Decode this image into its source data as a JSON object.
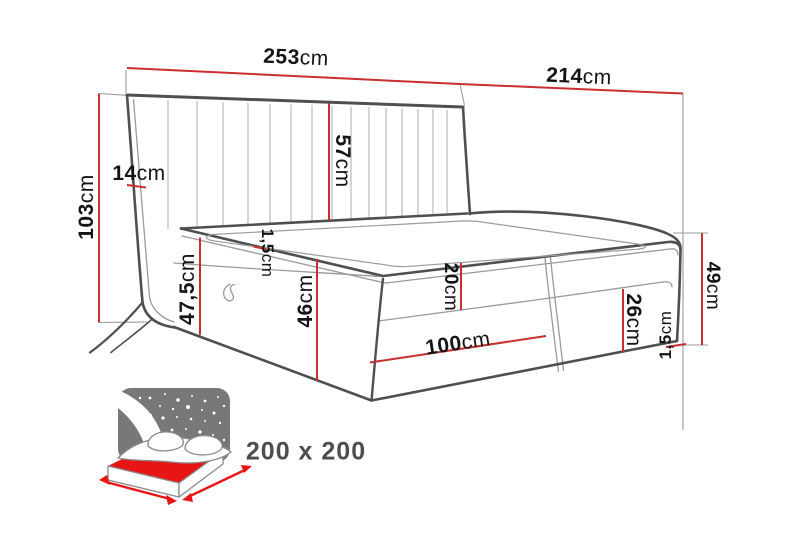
{
  "title": "Boxspring bed dimension drawing",
  "unit": "cm",
  "labels": [
    {
      "id": "headboard-width",
      "value": "253",
      "unit": "cm"
    },
    {
      "id": "bed-length",
      "value": "214",
      "unit": "cm"
    },
    {
      "id": "headboard-height",
      "value": "103",
      "unit": "cm"
    },
    {
      "id": "headboard-wing-depth",
      "value": "14",
      "unit": "cm"
    },
    {
      "id": "headboard-above-mattress",
      "value": "57",
      "unit": "cm"
    },
    {
      "id": "mattress-topper-left",
      "value": "1,5",
      "unit": "cm"
    },
    {
      "id": "side-height-total",
      "value": "47,5",
      "unit": "cm"
    },
    {
      "id": "base-height",
      "value": "46",
      "unit": "cm"
    },
    {
      "id": "mattress-height",
      "value": "20",
      "unit": "cm"
    },
    {
      "id": "storage-box-height",
      "value": "26",
      "unit": "cm"
    },
    {
      "id": "half-width",
      "value": "100",
      "unit": "cm"
    },
    {
      "id": "foot-end-height",
      "value": "49",
      "unit": "cm"
    },
    {
      "id": "mattress-topper-right",
      "value": "1,5",
      "unit": "cm"
    }
  ],
  "size_badge": {
    "text": "200 x 200"
  },
  "colors": {
    "background": "#ffffff",
    "dimension_red": "#c92f2f",
    "outline_dark": "#4f4f4f",
    "line_light": "#9a9a9a",
    "label_black": "#141414",
    "icon_gray": "#787878",
    "icon_red": "#e81515",
    "badge_gray": "#4d4d4d"
  }
}
